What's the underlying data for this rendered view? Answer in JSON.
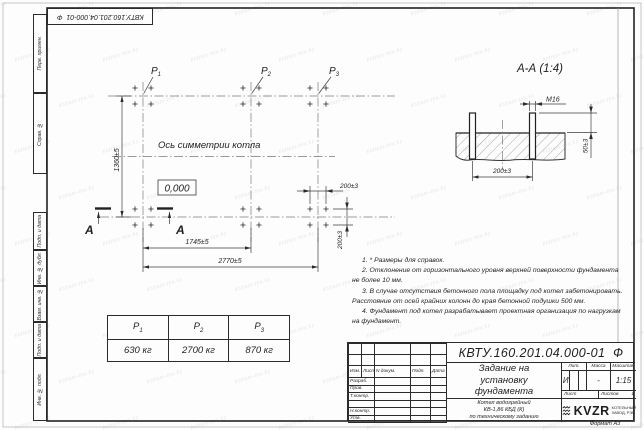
{
  "page": {
    "format_label": "Формат А3",
    "watermark": "kotlam-tex.kz"
  },
  "corner_stamp": {
    "number": "КВТУ.160.201.04.000-01  Ф"
  },
  "margin_blocks": [
    {
      "label": "Перв. примен."
    },
    {
      "label": "Справ. №"
    },
    {
      "label": "Подп. и дата"
    },
    {
      "label": "Инв. № дубл."
    },
    {
      "label": "Взам. инв. №"
    },
    {
      "label": "Подп. и дата"
    },
    {
      "label": "Инв. № подл."
    }
  ],
  "plan": {
    "labels": {
      "p1": {
        "base": "Р",
        "sub": "1"
      },
      "p2": {
        "base": "Р",
        "sub": "2"
      },
      "p3": {
        "base": "Р",
        "sub": "3"
      }
    },
    "axis_label": "Ось симметрии котла",
    "elevation": "0,000",
    "section_letter": "А",
    "dims": {
      "height": "1360±5",
      "span_p1_p2": "1745±5",
      "span_total": "2770±5",
      "bolt_x": "200±3",
      "bolt_y": "200±3"
    }
  },
  "section": {
    "title": "А-А (1:4)",
    "thread": "М16",
    "dims": {
      "spacing": "200±3",
      "protrusion": "50±3"
    }
  },
  "loads_table": {
    "columns": [
      {
        "base": "Р",
        "sub": "1"
      },
      {
        "base": "Р",
        "sub": "2"
      },
      {
        "base": "Р",
        "sub": "3"
      }
    ],
    "values": [
      "630 кг",
      "2700 кг",
      "870 кг"
    ]
  },
  "notes": [
    "1. * Размеры для справок.",
    "2. Отклонение от горизонтального уровня верхней поверхности фундамента не более 10 мм.",
    "3. В случае отсутствия бетонного пола площадку под котел забетонировать. Расстояние от осей крайних колонн до края бетонной подушки 500 мм.",
    "4. Фундамент под котел разрабатывает проектная организация по нагрузкам на фундамент."
  ],
  "title_block": {
    "number": "КВТУ.160.201.04.000-01  Ф",
    "title": "Задание на установку фундамента",
    "product_lines": [
      "Котел водогрейный",
      "КВ-1,86 КБД (К)",
      "по техническому заданию"
    ],
    "header_cols": [
      "Изм.",
      "Лист",
      "N докум.",
      "Подп.",
      "Дата"
    ],
    "sig_rows": [
      "Разраб.",
      "Пров.",
      "Т.контр.",
      "",
      "Н.контр.",
      "Утв."
    ],
    "lit_header": "Лит.",
    "mass_header": "Масса",
    "scale_header": "Масштаб",
    "lit_value": "И",
    "mass_value": "-",
    "scale_value": "1:15",
    "sheet_label": "Лист",
    "sheets_label": "Листов",
    "sheets_value": "1",
    "logo_text": "KVZR",
    "logo_sub": [
      "КОТЕЛЬНЫЙ",
      "ЗАВОД, РЭП"
    ]
  }
}
